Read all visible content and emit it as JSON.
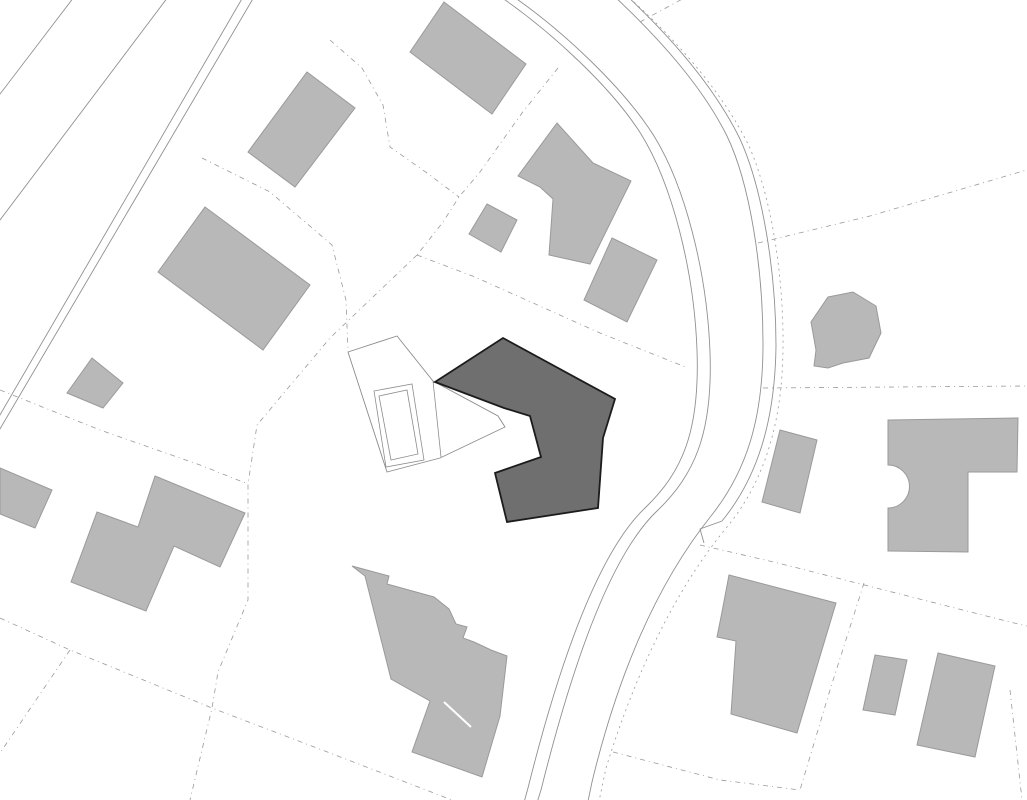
{
  "canvas": {
    "width": 1027,
    "height": 800,
    "background": "#ffffff"
  },
  "colors": {
    "building_fill": "#b8b8b8",
    "building_stroke": "#9a9a9a",
    "featured_fill": "#6f6f6f",
    "featured_stroke": "#1c1c1c",
    "outlined_fill": "#ffffff",
    "outlined_stroke": "#8c8c8c",
    "road_line": "#8f9191",
    "parcel_line": "#9a9a9a",
    "seam": "#ffffff"
  },
  "site_plan": {
    "buildings": [
      {
        "id": "building-1",
        "points": "444,2 526,64 492,114 410,52"
      },
      {
        "id": "building-2",
        "points": "307,72 355,108 295,187 248,152"
      },
      {
        "id": "building-3",
        "points": "205,207 310,285 263,350 158,272"
      },
      {
        "id": "building-4",
        "points": "557,123 593,163 631,181 590,264 549,255 553,199 540,187 518,176"
      },
      {
        "id": "building-5",
        "points": "487,204 517,220 501,252 469,234"
      },
      {
        "id": "building-6",
        "points": "612,238 657,260 627,322 584,300"
      },
      {
        "id": "building-7",
        "points": "828,297 853,292 876,306 881,333 869,358 843,363 828,368 814,366 816,350 811,322"
      },
      {
        "id": "building-8",
        "points": "780,430 817,440 800,513 762,502"
      },
      {
        "id": "building-9",
        "path": "M888,420 L1018,418 L1017,472 L968,472 L968,552 L888,551 L888,508 A21.5,21.5 0 0 0 888,465 Z"
      },
      {
        "id": "building-10",
        "points": "729,575 836,603 797,733 731,714 736,641 717,637 722,612"
      },
      {
        "id": "building-11",
        "points": "875,655 907,660 895,715 863,710"
      },
      {
        "id": "building-12",
        "points": "938,653 995,666 975,757 917,745"
      },
      {
        "id": "building-13",
        "points": "92,358 123,383 103,408 67,393"
      },
      {
        "id": "building-14",
        "points": "0,468 52,490 35,528 0,514"
      },
      {
        "id": "building-15",
        "points": "155,476 245,513 220,567 174,546 146,611 71,582 97,512 138,527"
      },
      {
        "id": "building-16",
        "points": "352,566 389,576 387,584 434,597 449,609 456,624 467,627 463,638 474,642 491,650 507,656 500,716 482,777 412,752 430,701 391,679 365,576"
      }
    ],
    "building_seams": [
      {
        "id": "seam-building-16",
        "points": "444,702 471,727"
      }
    ],
    "featured_building": {
      "id": "featured-building",
      "points": "503,338 615,399 603,438 598,508 507,522 495,473 541,457 530,416 504,408 435,382"
    },
    "outlined_building": {
      "id": "outlined-building",
      "outline": "348,352 397,336 433,381 498,416 505,427 440,458 387,472",
      "inner_lines": [
        {
          "id": "courtyard-outer",
          "points": "374,391 412,384 424,460 386,467",
          "closed": true
        },
        {
          "id": "courtyard-inner",
          "points": "379,396 407,390 418,454 391,460",
          "closed": true
        },
        {
          "id": "fold-crease",
          "points": "433,381 441,457",
          "closed": false
        }
      ]
    },
    "roads": [
      {
        "id": "street-line-1",
        "path": "M74,-3 L-3,98"
      },
      {
        "id": "street-line-2",
        "path": "M168,-3 L-3,224"
      },
      {
        "id": "street-line-3",
        "path": "M243,-3 L-3,420"
      },
      {
        "id": "street-line-4",
        "path": "M254,-3 L-3,434"
      },
      {
        "id": "curved-road-west-outer",
        "path": "M498,-5 C552,32 612,88 641,134 C672,184 694,270 697,350 C700,432 682,472 646,507 C601,549 562,652 528,788 L523,806"
      },
      {
        "id": "curved-road-west-inner",
        "path": "M511,-5 C565,32 625,90 654,136 C685,186 707,272 710,352 C713,434 694,475 658,510 C613,552 575,654 541,790 L536,806"
      },
      {
        "id": "curved-road-east-inner",
        "path": "M613,-5 C663,42 703,88 727,136 C750,184 763,268 763,344 C763,420 746,472 711,516 C663,576 621,662 592,782 L587,806"
      },
      {
        "id": "curved-road-east-outer",
        "path": "M626,-5 C676,42 716,90 740,139 C762,187 776,270 776,346 C775,420 758,477 722,521 L700,529 L704,543"
      }
    ],
    "road_dotted": [
      {
        "id": "roadside-dotted",
        "path": "M634,2 C684,48 724,96 748,144 C770,192 784,272 783,350 C782,424 764,482 727,527 C678,586 637,668 606,768 L598,806"
      }
    ],
    "parcel_lines": [
      {
        "id": "parcel-1",
        "points": "202,158 270,192 332,245 346,300 348,352"
      },
      {
        "id": "parcel-2",
        "points": "330,40 362,68 383,105 390,147 427,173 459,197"
      },
      {
        "id": "parcel-3",
        "points": "558,68 522,113 480,172 459,197 443,222 417,255"
      },
      {
        "id": "parcel-4",
        "points": "417,255 475,277 600,333 688,368"
      },
      {
        "id": "parcel-5",
        "points": "0,390 100,430 200,465 248,484"
      },
      {
        "id": "parcel-6",
        "points": "417,255 330,338 257,425 248,484 248,600 218,672 212,708 190,800"
      },
      {
        "id": "parcel-7",
        "points": "0,618 70,650 212,708 330,753 452,800"
      },
      {
        "id": "parcel-8",
        "points": "70,650 0,753"
      },
      {
        "id": "parcel-9",
        "points": "613,752 720,780 800,790"
      },
      {
        "id": "parcel-10",
        "points": "864,583 830,690 800,790"
      },
      {
        "id": "parcel-11",
        "points": "758,243 870,216 1013,174 1027,170"
      },
      {
        "id": "parcel-12",
        "points": "763,388 1027,386"
      },
      {
        "id": "parcel-13",
        "points": "700,545 778,563 1010,622 1027,626"
      },
      {
        "id": "parcel-14",
        "points": "640,22 686,-3"
      },
      {
        "id": "parcel-15",
        "points": "1010,690 1022,800"
      }
    ]
  }
}
